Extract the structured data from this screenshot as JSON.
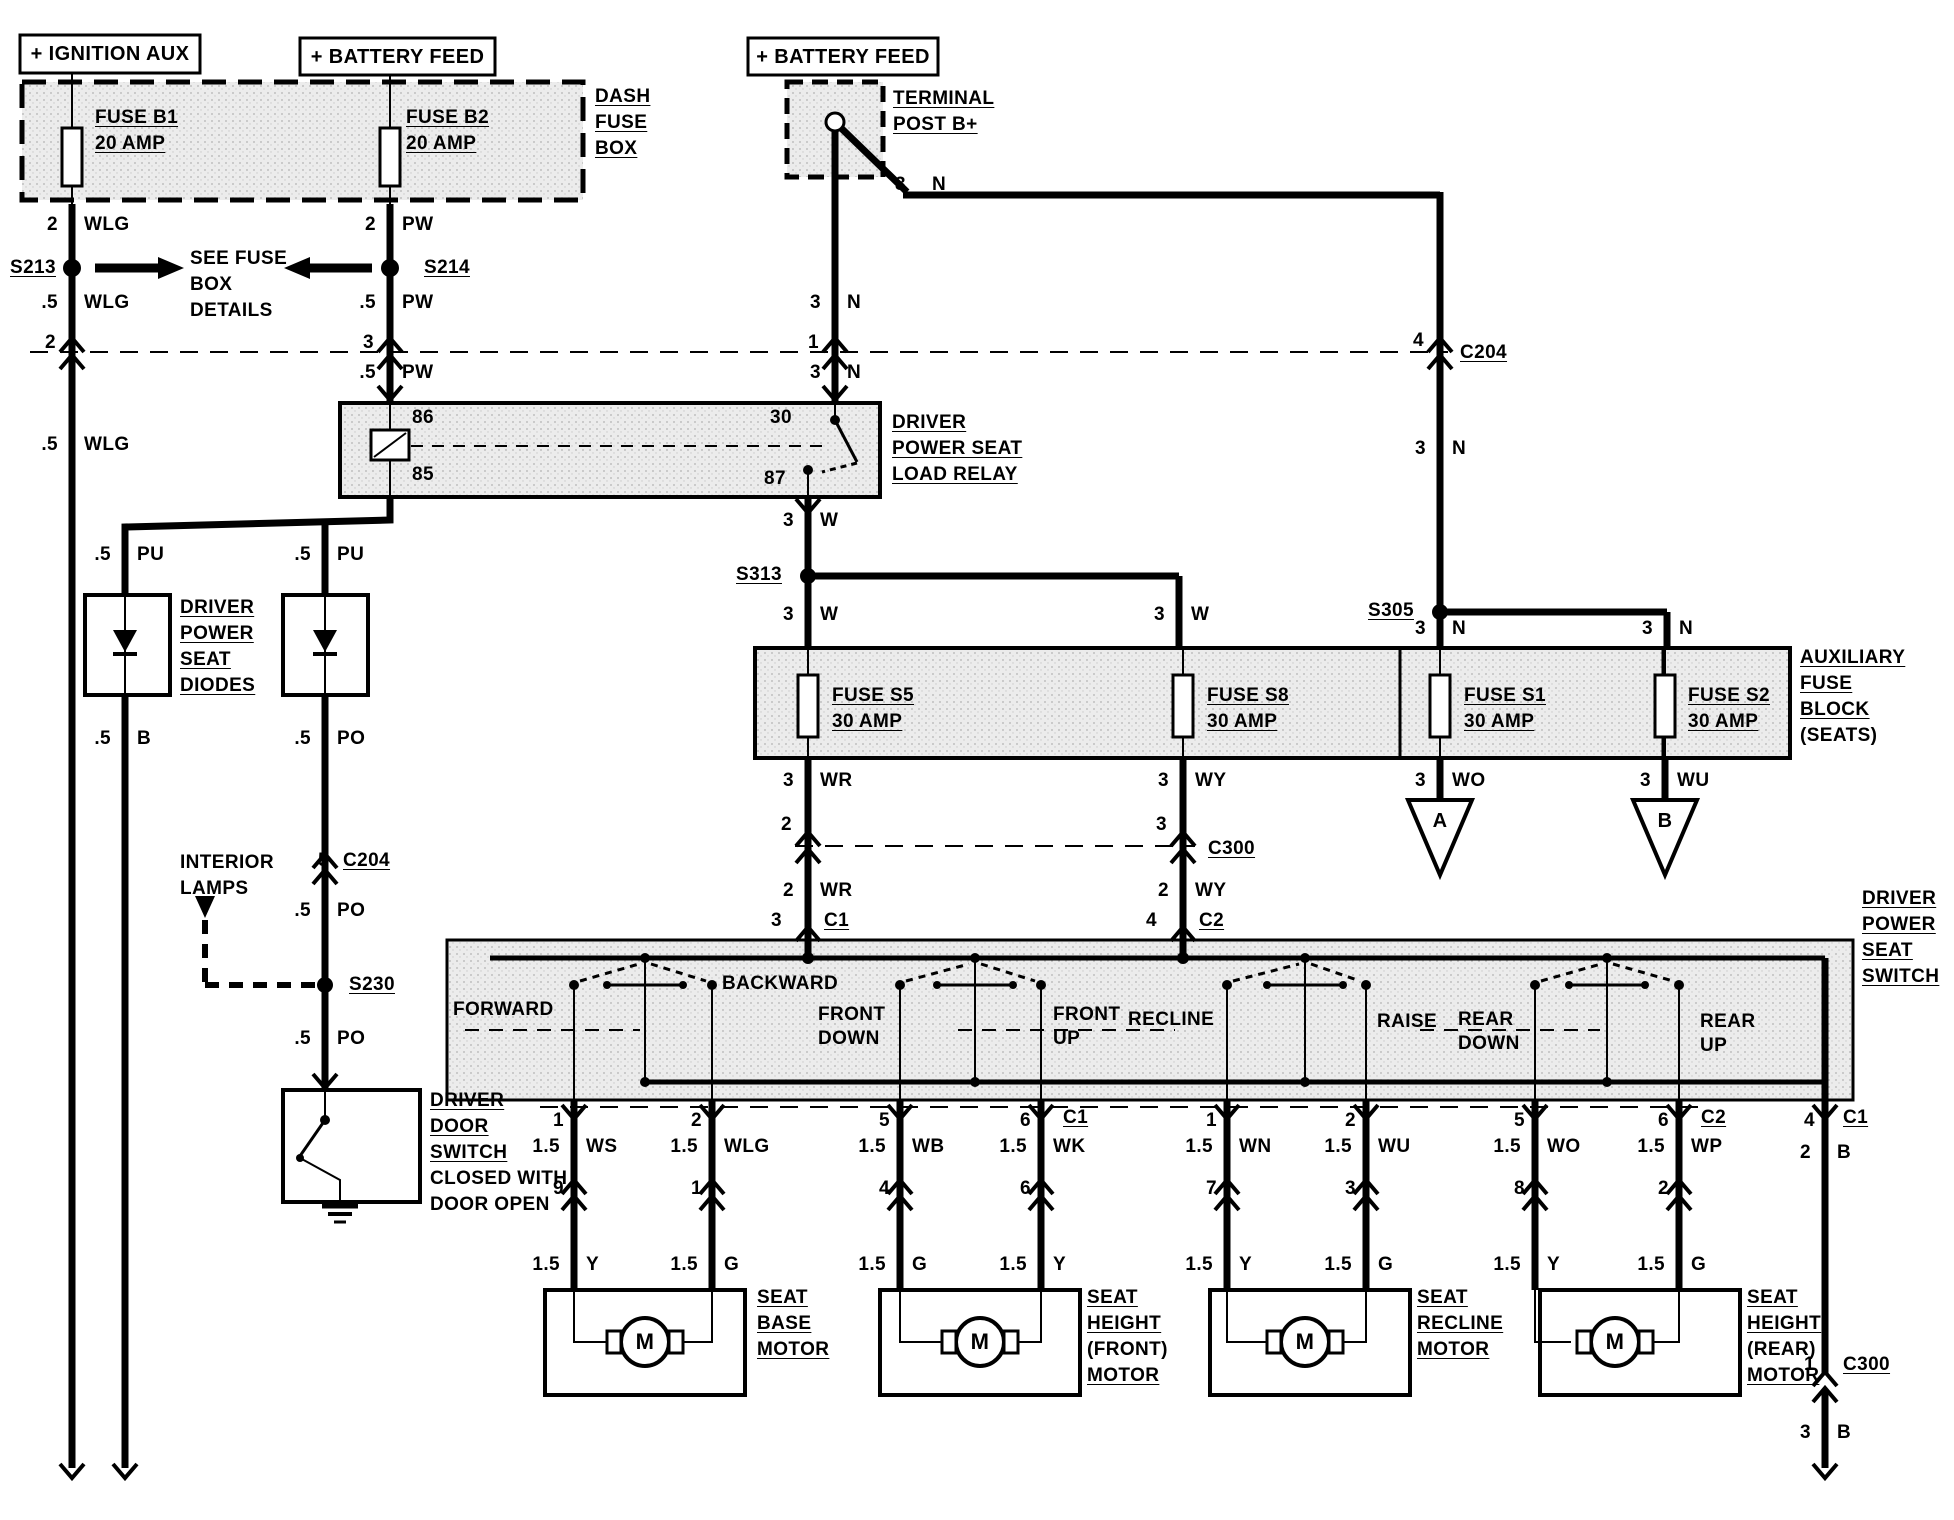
{
  "sources": {
    "ignition_aux": "+ IGNITION AUX",
    "battery_feed_1": "+ BATTERY FEED",
    "battery_feed_2": "+ BATTERY FEED"
  },
  "terminal_post": {
    "lines": [
      "TERMINAL",
      "POST B+"
    ]
  },
  "dash_fuse_box": {
    "lines": [
      "DASH",
      "FUSE",
      "BOX"
    ],
    "fuse_b1": {
      "name": "FUSE B1",
      "rating": "20 AMP"
    },
    "fuse_b2": {
      "name": "FUSE B2",
      "rating": "20 AMP"
    }
  },
  "see_fuse_note": {
    "lines": [
      "SEE FUSE",
      "BOX",
      "DETAILS"
    ]
  },
  "splices": {
    "s213": "S213",
    "s214": "S214",
    "s313": "S313",
    "s305": "S305",
    "s230": "S230"
  },
  "connector_ids": {
    "c204": "C204",
    "c300": "C300",
    "c1_top": "C1",
    "c2_top": "C2",
    "c1_bottom": "C1",
    "c2_bottom": "C2",
    "c1_far": "C1",
    "c204_lamp": "C204",
    "c300_bottom": "C300"
  },
  "relay": {
    "lines": [
      "DRIVER",
      "POWER SEAT",
      "LOAD RELAY"
    ],
    "pin_86": "86",
    "pin_85": "85",
    "pin_30": "30",
    "pin_87": "87"
  },
  "aux_fuse_block": {
    "lines_underlined": [
      "AUXILIARY",
      "FUSE",
      "BLOCK"
    ],
    "line_plain": "(SEATS)",
    "fuse_s5": {
      "name": "FUSE S5",
      "rating": "30 AMP"
    },
    "fuse_s8": {
      "name": "FUSE S8",
      "rating": "30 AMP"
    },
    "fuse_s1": {
      "name": "FUSE S1",
      "rating": "30 AMP"
    },
    "fuse_s2": {
      "name": "FUSE S2",
      "rating": "30 AMP"
    }
  },
  "triangle_a": "A",
  "triangle_b": "B",
  "diodes": {
    "lines": [
      "DRIVER",
      "POWER",
      "SEAT",
      "DIODES"
    ]
  },
  "interior_lamps": {
    "lines": [
      "INTERIOR",
      "LAMPS"
    ]
  },
  "door_switch": {
    "lines_underlined": [
      "DRIVER",
      "DOOR",
      "SWITCH"
    ],
    "lines_plain": [
      "CLOSED WITH",
      "DOOR OPEN"
    ]
  },
  "seat_switch": {
    "lines": [
      "DRIVER",
      "POWER",
      "SEAT",
      "SWITCH"
    ],
    "positions": [
      "FORWARD",
      "BACKWARD",
      "FRONT DOWN",
      "FRONT UP",
      "RECLINE",
      "RAISE",
      "REAR DOWN",
      "REAR UP"
    ]
  },
  "motors": [
    {
      "lines": [
        "SEAT",
        "BASE",
        "MOTOR"
      ],
      "symbol": "M"
    },
    {
      "lines": [
        "SEAT",
        "HEIGHT",
        "(FRONT)",
        "MOTOR"
      ],
      "symbol": "M"
    },
    {
      "lines": [
        "SEAT",
        "RECLINE",
        "MOTOR"
      ],
      "symbol": "M"
    },
    {
      "lines": [
        "SEAT",
        "HEIGHT",
        "(REAR)",
        "MOTOR"
      ],
      "symbol": "M"
    }
  ],
  "pins": {
    "c204_wlg": "2",
    "c204_pw": "3",
    "c204_n": "1",
    "c204_n_right": "4",
    "c300_wr": "2",
    "c300_wy": "3",
    "c1_top": "3",
    "c2_top": "4",
    "po_c204": "5",
    "b_c300": "1",
    "c1_row": [
      "1",
      "2",
      "5",
      "6"
    ],
    "c2_row": [
      "1",
      "2",
      "5",
      "6"
    ],
    "c1_far": "4",
    "mid_row": [
      "9",
      "1",
      "4",
      "6",
      "7",
      "3",
      "8",
      "2"
    ]
  },
  "wires": [
    {
      "s": "2",
      "c": "WLG"
    },
    {
      "s": ".5",
      "c": "WLG"
    },
    {
      "s": ".5",
      "c": "WLG"
    },
    {
      "s": "2",
      "c": "PW"
    },
    {
      "s": ".5",
      "c": "PW"
    },
    {
      "s": ".5",
      "c": "PW"
    },
    {
      "s": "3",
      "c": "N"
    },
    {
      "s": "3",
      "c": "N"
    },
    {
      "s": "3",
      "c": "N"
    },
    {
      "s": "3",
      "c": "N"
    },
    {
      "s": "3",
      "c": "N"
    },
    {
      "s": "3",
      "c": "N"
    },
    {
      "s": "3",
      "c": "W"
    },
    {
      "s": "3",
      "c": "W"
    },
    {
      "s": "3",
      "c": "W"
    },
    {
      "s": "3",
      "c": "WR"
    },
    {
      "s": "2",
      "c": "WR"
    },
    {
      "s": "3",
      "c": "WY"
    },
    {
      "s": "2",
      "c": "WY"
    },
    {
      "s": "3",
      "c": "WO"
    },
    {
      "s": "3",
      "c": "WU"
    },
    {
      "s": ".5",
      "c": "PU"
    },
    {
      "s": ".5",
      "c": "PU"
    },
    {
      "s": ".5",
      "c": "B"
    },
    {
      "s": ".5",
      "c": "PO"
    },
    {
      "s": ".5",
      "c": "PO"
    },
    {
      "s": ".5",
      "c": "PO"
    },
    {
      "s": "1.5",
      "c": "WS"
    },
    {
      "s": "1.5",
      "c": "WLG"
    },
    {
      "s": "1.5",
      "c": "WB"
    },
    {
      "s": "1.5",
      "c": "WK"
    },
    {
      "s": "1.5",
      "c": "WN"
    },
    {
      "s": "1.5",
      "c": "WU"
    },
    {
      "s": "1.5",
      "c": "WO"
    },
    {
      "s": "1.5",
      "c": "WP"
    },
    {
      "s": "2",
      "c": "B"
    },
    {
      "s": "1.5",
      "c": "Y"
    },
    {
      "s": "1.5",
      "c": "G"
    },
    {
      "s": "1.5",
      "c": "G"
    },
    {
      "s": "1.5",
      "c": "Y"
    },
    {
      "s": "1.5",
      "c": "Y"
    },
    {
      "s": "1.5",
      "c": "G"
    },
    {
      "s": "1.5",
      "c": "Y"
    },
    {
      "s": "1.5",
      "c": "G"
    },
    {
      "s": "3",
      "c": "B"
    }
  ]
}
